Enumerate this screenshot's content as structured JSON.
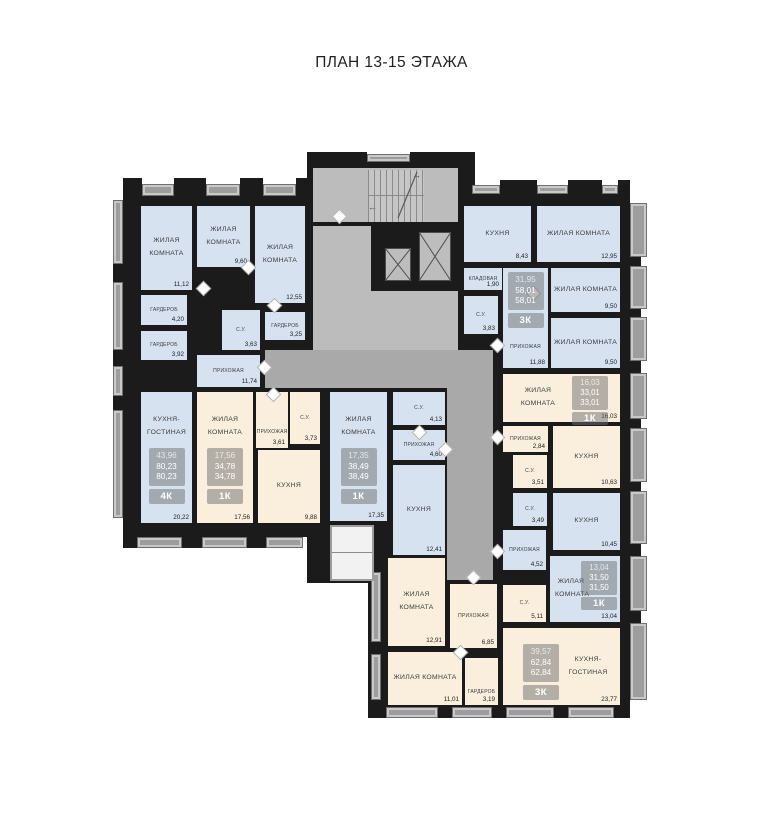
{
  "title": "ПЛАН 13-15 ЭТАЖА",
  "apartments": {
    "apt_4k": {
      "type": "4К",
      "living_area": "43,96",
      "total_area": "80,23",
      "sale_area": "80,23",
      "rooms": {
        "living_1": {
          "name": "ЖИЛАЯ КОМНАТА",
          "area": "11,12"
        },
        "living_2": {
          "name": "ЖИЛАЯ КОМНАТА",
          "area": "9,60"
        },
        "living_3": {
          "name": "ЖИЛАЯ КОМНАТА",
          "area": "12,55"
        },
        "wardrobe_1": {
          "name": "ГАРДЕРОБ",
          "area": "4,20"
        },
        "wardrobe_2": {
          "name": "ГАРДЕРОБ",
          "area": "3,92"
        },
        "bathroom": {
          "name": "С.У.",
          "area": "3,63"
        },
        "wardrobe_3": {
          "name": "ГАРДЕРОБ",
          "area": "3,25"
        },
        "hallway": {
          "name": "ПРИХОЖАЯ",
          "area": "11,74"
        },
        "kitchen_living": {
          "name": "КУХНЯ-ГОСТИНАЯ",
          "area": "20,22"
        }
      }
    },
    "apt_1k_a": {
      "type": "1К",
      "living_area": "17,56",
      "total_area": "34,78",
      "sale_area": "34,78",
      "rooms": {
        "living": {
          "name": "ЖИЛАЯ КОМНАТА",
          "area": "17,56"
        },
        "hallway": {
          "name": "ПРИХОЖАЯ",
          "area": "3,61"
        },
        "bathroom": {
          "name": "С.У.",
          "area": "3,73"
        },
        "kitchen": {
          "name": "КУХНЯ",
          "area": "9,88"
        }
      }
    },
    "apt_1k_b": {
      "type": "1К",
      "living_area": "17,35",
      "total_area": "38,49",
      "sale_area": "38,49",
      "rooms": {
        "living": {
          "name": "ЖИЛАЯ КОМНАТА",
          "area": "17,35"
        },
        "bathroom": {
          "name": "С.У.",
          "area": "4,13"
        },
        "hallway": {
          "name": "ПРИХОЖАЯ",
          "area": "4,60"
        },
        "kitchen": {
          "name": "КУХНЯ",
          "area": "12,41"
        }
      }
    },
    "apt_3k_a": {
      "type": "3К",
      "living_area": "31,95",
      "total_area": "58,01",
      "sale_area": "58,01",
      "rooms": {
        "kitchen": {
          "name": "КУХНЯ",
          "area": "8,43"
        },
        "living_1": {
          "name": "ЖИЛАЯ КОМНАТА",
          "area": "12,95"
        },
        "storage": {
          "name": "КЛАДОВАЯ",
          "area": "1,90"
        },
        "bathroom": {
          "name": "С.У.",
          "area": "3,83"
        },
        "hallway": {
          "name": "ПРИХОЖАЯ",
          "area": "11,88"
        },
        "living_2": {
          "name": "ЖИЛАЯ КОМНАТА",
          "area": "9,50"
        },
        "living_3": {
          "name": "ЖИЛАЯ КОМНАТА",
          "area": "9,50"
        }
      }
    },
    "apt_1k_c": {
      "type": "1К",
      "living_area": "16,03",
      "total_area": "33,01",
      "sale_area": "33,01",
      "rooms": {
        "living": {
          "name": "ЖИЛАЯ КОМНАТА",
          "area": "16,03"
        },
        "hallway": {
          "name": "ПРИХОЖАЯ",
          "area": "2,84"
        },
        "bathroom": {
          "name": "С.У.",
          "area": "3,51"
        },
        "kitchen": {
          "name": "КУХНЯ",
          "area": "10,63"
        }
      }
    },
    "apt_1k_d": {
      "type": "1К",
      "living_area": "13,04",
      "total_area": "31,50",
      "sale_area": "31,50",
      "rooms": {
        "bathroom": {
          "name": "С.У.",
          "area": "3,49"
        },
        "kitchen": {
          "name": "КУХНЯ",
          "area": "10,45"
        },
        "hallway": {
          "name": "ПРИХОЖАЯ",
          "area": "4,52"
        },
        "living": {
          "name": "ЖИЛАЯ КОМНАТА",
          "area": "13,04"
        }
      }
    },
    "apt_3k_b": {
      "type": "3К",
      "living_area": "39,57",
      "total_area": "62,84",
      "sale_area": "62,84",
      "rooms": {
        "living_1": {
          "name": "ЖИЛАЯ КОМНАТА",
          "area": "12,91"
        },
        "hallway": {
          "name": "ПРИХОЖАЯ",
          "area": "6,85"
        },
        "bathroom": {
          "name": "С.У.",
          "area": "5,11"
        },
        "living_2": {
          "name": "ЖИЛАЯ КОМНАТА",
          "area": "11,01"
        },
        "wardrobe": {
          "name": "ГАРДЕРОБ",
          "area": "3,19"
        },
        "kitchen_living": {
          "name": "КУХНЯ-ГОСТИНАЯ",
          "area": "23,77"
        }
      }
    }
  },
  "colors": {
    "wall": "#1b1b1b",
    "room_blue": "#d7e2f1",
    "room_beige": "#f9efdc",
    "common_gray": "#a9a9a9"
  }
}
